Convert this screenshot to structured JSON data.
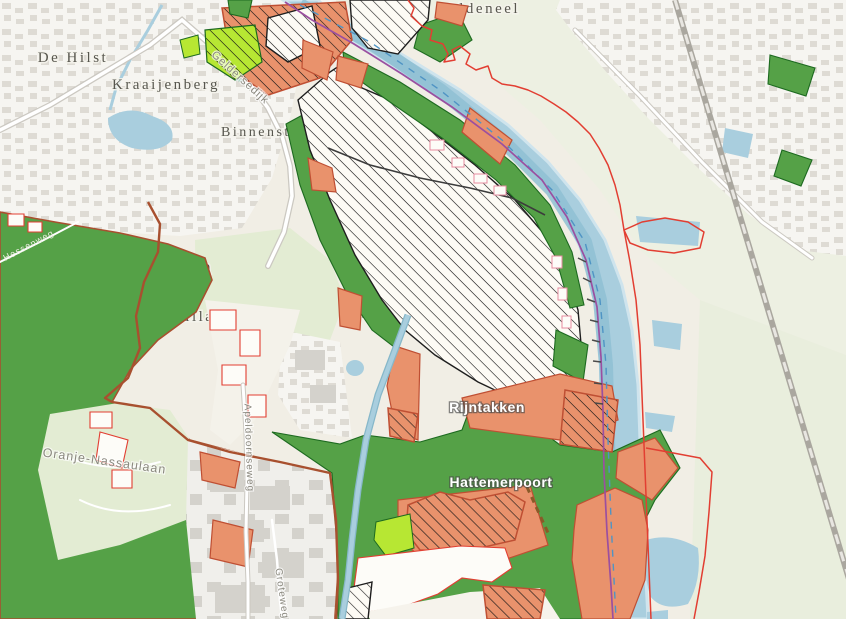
{
  "map": {
    "labels": {
      "de_hilst": "De Hilst",
      "kraaijenberg": "Kraaijenberg",
      "binnenstad": "Binnenstad",
      "oldeneel": "Oldeneel",
      "hattem": "Hattem",
      "villapark": "Villapark",
      "het_veen": "Het Veen",
      "rijntakken": "Rijntakken",
      "hattemerpoort": "Hattemerpoort",
      "oranje_nassaulaan": "Oranje-Nassaulaan",
      "geldersedijk": "Geldersedijk",
      "hessenweg": "Hessenweg",
      "apeldoornseweg": "Apeldoornseweg",
      "groteweg": "Groteweg"
    },
    "colors": {
      "cream": "#f1eee5",
      "paleField": "#edf0e2",
      "paleStrip": "#e9eedd",
      "paleWood": "#e3ecd3",
      "urbanBg": "#f6f5f1",
      "building": "#dedbd4",
      "industrialBg": "#f0efeb",
      "industrialBuilding": "#d4d2cc",
      "water": "#a9cede",
      "waterLight": "#cfe4ed",
      "waterDark": "#8fc0d4",
      "green": "#55a147",
      "greenBorder": "#1d6a20",
      "salmon": "#e9926c",
      "salmonBorder": "#bf4f33",
      "lime": "#b7e733",
      "hatchBg": "#fdfbf5",
      "redLine": "#e23e32",
      "purple": "#9b4fa0",
      "brown": "#a8502f",
      "railway": "#aaa79f",
      "roadCasing": "#cbc8c1",
      "labelGray": "#57564e",
      "roadLabel": "#8b897f",
      "labelWhite": "#ffffff"
    }
  }
}
